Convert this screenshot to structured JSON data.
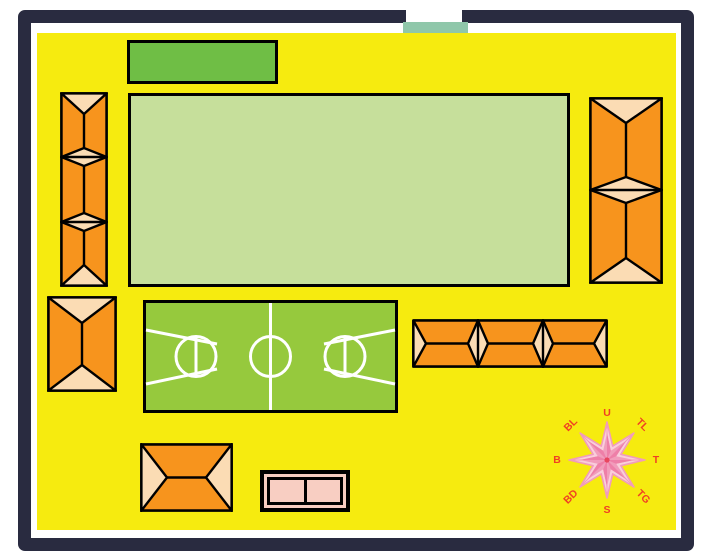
{
  "map": {
    "title": "school-grounds-site-plan",
    "features": {
      "boundary_wall": "dark perimeter wall with front gate opening",
      "entrance_gate": "teal gate block at top opening",
      "hall": "green hall building (top)",
      "main_field": "large light-green field (center)",
      "basketball_court": "green court with white center line, center circle and two keyed free-throw circles",
      "roof_buildings": [
        "left-long-row-3-sections",
        "left-small-single-section",
        "right-row-2-sections",
        "east-row-3-sections-horizontal",
        "south-single-section-horizontal"
      ],
      "annex": "small pink two-room structure (bottom center)"
    }
  },
  "compass": {
    "n": "U",
    "ne": "TL",
    "e": "T",
    "se": "TG",
    "s": "S",
    "sw": "BD",
    "w": "B",
    "nw": "BL"
  },
  "colors": {
    "ground": "#F6EB0F",
    "wall": "#292B40",
    "field": "#C6DF9B",
    "hall": "#6FBE45",
    "court": "#96C93D",
    "court_line": "#FFFFFF",
    "roof_orange": "#F7941D",
    "roof_hip": "#FBDCB4",
    "outline": "#000000",
    "gate": "#8FC7AA",
    "annex_pink": "#F8CEC2",
    "compass_light": "#F9CEDB",
    "compass_mid": "#F19CBB",
    "compass_dark": "#EE7FA8",
    "compass_center": "#E8465F",
    "compass_label": "#F04023"
  }
}
